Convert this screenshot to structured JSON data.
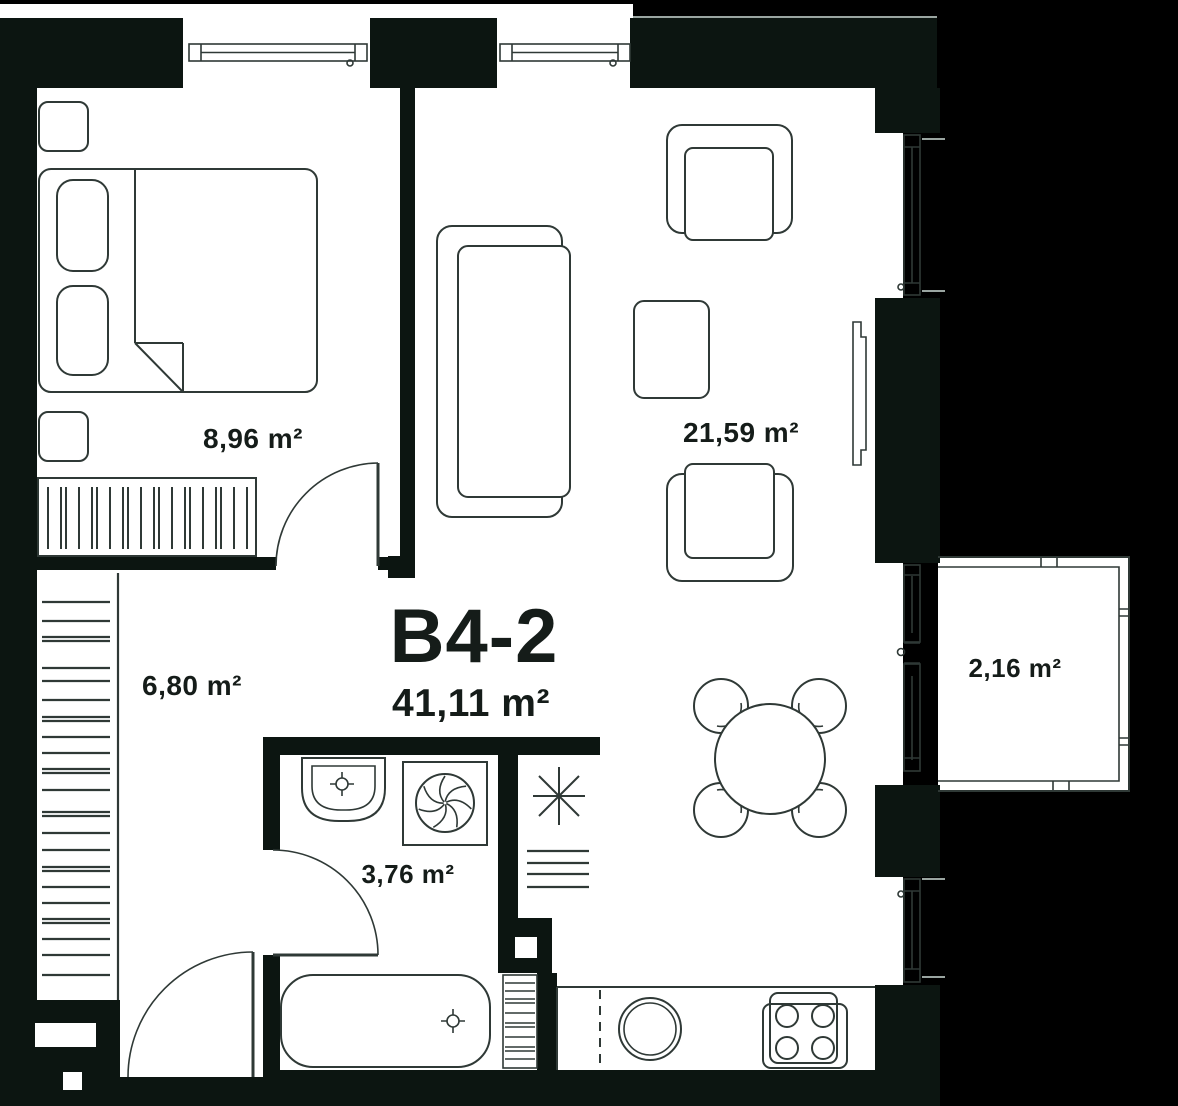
{
  "unit": {
    "code": "B4-2",
    "total_area": "41,11 m²"
  },
  "rooms": [
    {
      "name": "bedroom",
      "area": "8,96 m²"
    },
    {
      "name": "living-room-kitchen",
      "area": "21,59 m²"
    },
    {
      "name": "hallway",
      "area": "6,80 m²"
    },
    {
      "name": "bathroom",
      "area": "3,76 m²"
    },
    {
      "name": "balcony",
      "area": "2,16 m²"
    }
  ],
  "icons": {
    "ventilation_shaft": "asterisk-star",
    "washing_machine": "pinwheel-drum",
    "faucet": "crosshair",
    "stove": "four-burner-hob",
    "kitchen_sink": "double-circle"
  },
  "colors": {
    "background": "#000000",
    "wall": "#0c1511",
    "floor": "#ffffff",
    "line": "#2f3936",
    "text": "#151c19",
    "sill": "#9aa5a1"
  }
}
